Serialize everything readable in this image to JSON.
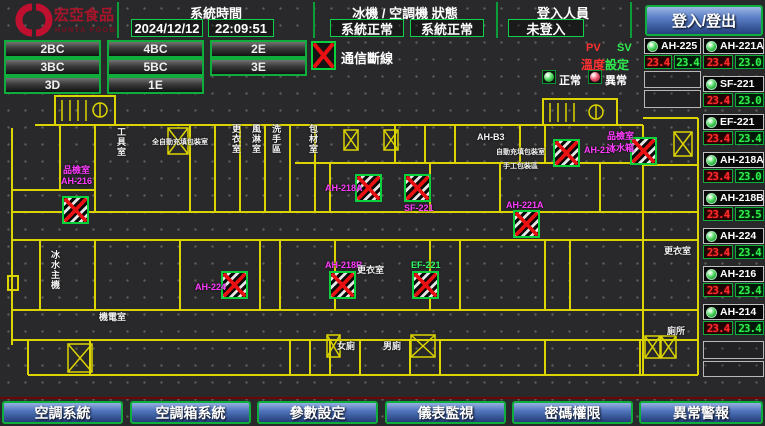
{
  "header": {
    "brand": {
      "name": "宏亞食品",
      "subtitle": "HUNYA FOODS"
    },
    "time_panel": {
      "title": "系統時間",
      "date": "2024/12/12",
      "time": "22:09:51"
    },
    "status_panel": {
      "title": "冰機 / 空調機 狀態",
      "chiller": "系統正常",
      "ahu": "系統正常"
    },
    "login_panel": {
      "title": "登入人員",
      "user": "未登入",
      "button": "登入/登出"
    }
  },
  "floor_buttons": [
    "2BC",
    "4BC",
    "2E",
    "3BC",
    "5BC",
    "3E",
    "3D",
    "1E"
  ],
  "legend": {
    "comm_loss": "通信斷線",
    "pv": "PV",
    "sv": "SV",
    "temp_label": "溫度",
    "set_label": "設定",
    "normal": "正常",
    "abnormal": "異常"
  },
  "units": {
    "col_a": [
      {
        "name": "AH-225",
        "pv": "23.4",
        "sv": "23.4",
        "lamp": "normal"
      }
    ],
    "col_b": [
      {
        "name": "AH-221A",
        "pv": "23.4",
        "sv": "23.0",
        "lamp": "normal"
      },
      {
        "name": "SF-221",
        "pv": "23.4",
        "sv": "23.0",
        "lamp": "normal"
      },
      {
        "name": "EF-221",
        "pv": "23.4",
        "sv": "23.4",
        "lamp": "normal"
      },
      {
        "name": "AH-218A",
        "pv": "23.4",
        "sv": "23.0",
        "lamp": "normal"
      },
      {
        "name": "AH-218B",
        "pv": "23.4",
        "sv": "23.5",
        "lamp": "normal"
      },
      {
        "name": "AH-224",
        "pv": "23.4",
        "sv": "23.4",
        "lamp": "normal"
      },
      {
        "name": "AH-216",
        "pv": "23.4",
        "sv": "23.4",
        "lamp": "normal"
      },
      {
        "name": "AH-214",
        "pv": "23.4",
        "sv": "23.4",
        "lamp": "normal"
      }
    ]
  },
  "nav_buttons": [
    {
      "id": "nav-ac-system",
      "label": "空調系統"
    },
    {
      "id": "nav-ahu-system",
      "label": "空調箱系統"
    },
    {
      "id": "nav-param-settings",
      "label": "參數設定"
    },
    {
      "id": "nav-meter-monitor",
      "label": "儀表監視"
    },
    {
      "id": "nav-password",
      "label": "密碼權限"
    },
    {
      "id": "nav-alarm",
      "label": "異常警報"
    }
  ],
  "map": {
    "markers": [
      {
        "x": 62,
        "y": 196
      },
      {
        "x": 355,
        "y": 174
      },
      {
        "x": 404,
        "y": 174
      },
      {
        "x": 553,
        "y": 139
      },
      {
        "x": 630,
        "y": 137
      },
      {
        "x": 513,
        "y": 210
      },
      {
        "x": 221,
        "y": 271
      },
      {
        "x": 329,
        "y": 271
      },
      {
        "x": 412,
        "y": 271
      }
    ],
    "labels": [
      {
        "t": "品檢室",
        "x": 63,
        "y": 166,
        "c": "magenta"
      },
      {
        "t": "AH-216",
        "x": 61,
        "y": 177,
        "c": "magenta"
      },
      {
        "t": "工具室",
        "x": 116,
        "y": 127,
        "c": "white",
        "v": true
      },
      {
        "t": "全自動充填包裝室",
        "x": 152,
        "y": 139,
        "c": "white",
        "s": 7
      },
      {
        "t": "更衣室",
        "x": 231,
        "y": 124,
        "c": "white",
        "v": true
      },
      {
        "t": "風淋室",
        "x": 251,
        "y": 124,
        "c": "white",
        "v": true
      },
      {
        "t": "洗手區",
        "x": 271,
        "y": 124,
        "c": "white",
        "v": true
      },
      {
        "t": "包材室",
        "x": 308,
        "y": 124,
        "c": "white",
        "v": true
      },
      {
        "t": "AH-B3",
        "x": 477,
        "y": 133,
        "c": "white"
      },
      {
        "t": "自動充填包裝室",
        "x": 496,
        "y": 149,
        "c": "white",
        "s": 7
      },
      {
        "t": "手工包裝區",
        "x": 503,
        "y": 163,
        "c": "white",
        "s": 7
      },
      {
        "t": "AH-218A",
        "x": 325,
        "y": 184,
        "c": "magenta"
      },
      {
        "t": "SF-221",
        "x": 404,
        "y": 204,
        "c": "magenta"
      },
      {
        "t": "AH-214",
        "x": 584,
        "y": 146,
        "c": "magenta"
      },
      {
        "t": "品檢室",
        "x": 607,
        "y": 132,
        "c": "magenta"
      },
      {
        "t": "冰水箱",
        "x": 607,
        "y": 144,
        "c": "magenta"
      },
      {
        "t": "AH-221A",
        "x": 506,
        "y": 201,
        "c": "magenta"
      },
      {
        "t": "AH-224",
        "x": 195,
        "y": 283,
        "c": "magenta"
      },
      {
        "t": "AH-218B",
        "x": 325,
        "y": 261,
        "c": "magenta"
      },
      {
        "t": "EF-221",
        "x": 411,
        "y": 261,
        "c": "green"
      },
      {
        "t": "更衣室",
        "x": 357,
        "y": 266,
        "c": "white"
      },
      {
        "t": "女廁",
        "x": 337,
        "y": 342,
        "c": "white"
      },
      {
        "t": "男廁",
        "x": 383,
        "y": 342,
        "c": "white"
      },
      {
        "t": "冰水主機",
        "x": 50,
        "y": 250,
        "c": "white",
        "v": true
      },
      {
        "t": "機電室",
        "x": 99,
        "y": 313,
        "c": "white"
      },
      {
        "t": "更衣室",
        "x": 664,
        "y": 247,
        "c": "white"
      },
      {
        "t": "廁所",
        "x": 667,
        "y": 327,
        "c": "white"
      }
    ]
  },
  "colors": {
    "accent_green": "#0fae3c",
    "alarm_red": "#ff2d2d",
    "value_green": "#2dee4e",
    "magenta": "#ff3cff",
    "wall_yellow": "#dcd400",
    "button_blue": "#3c5fae",
    "logo_red": "#c01030"
  }
}
